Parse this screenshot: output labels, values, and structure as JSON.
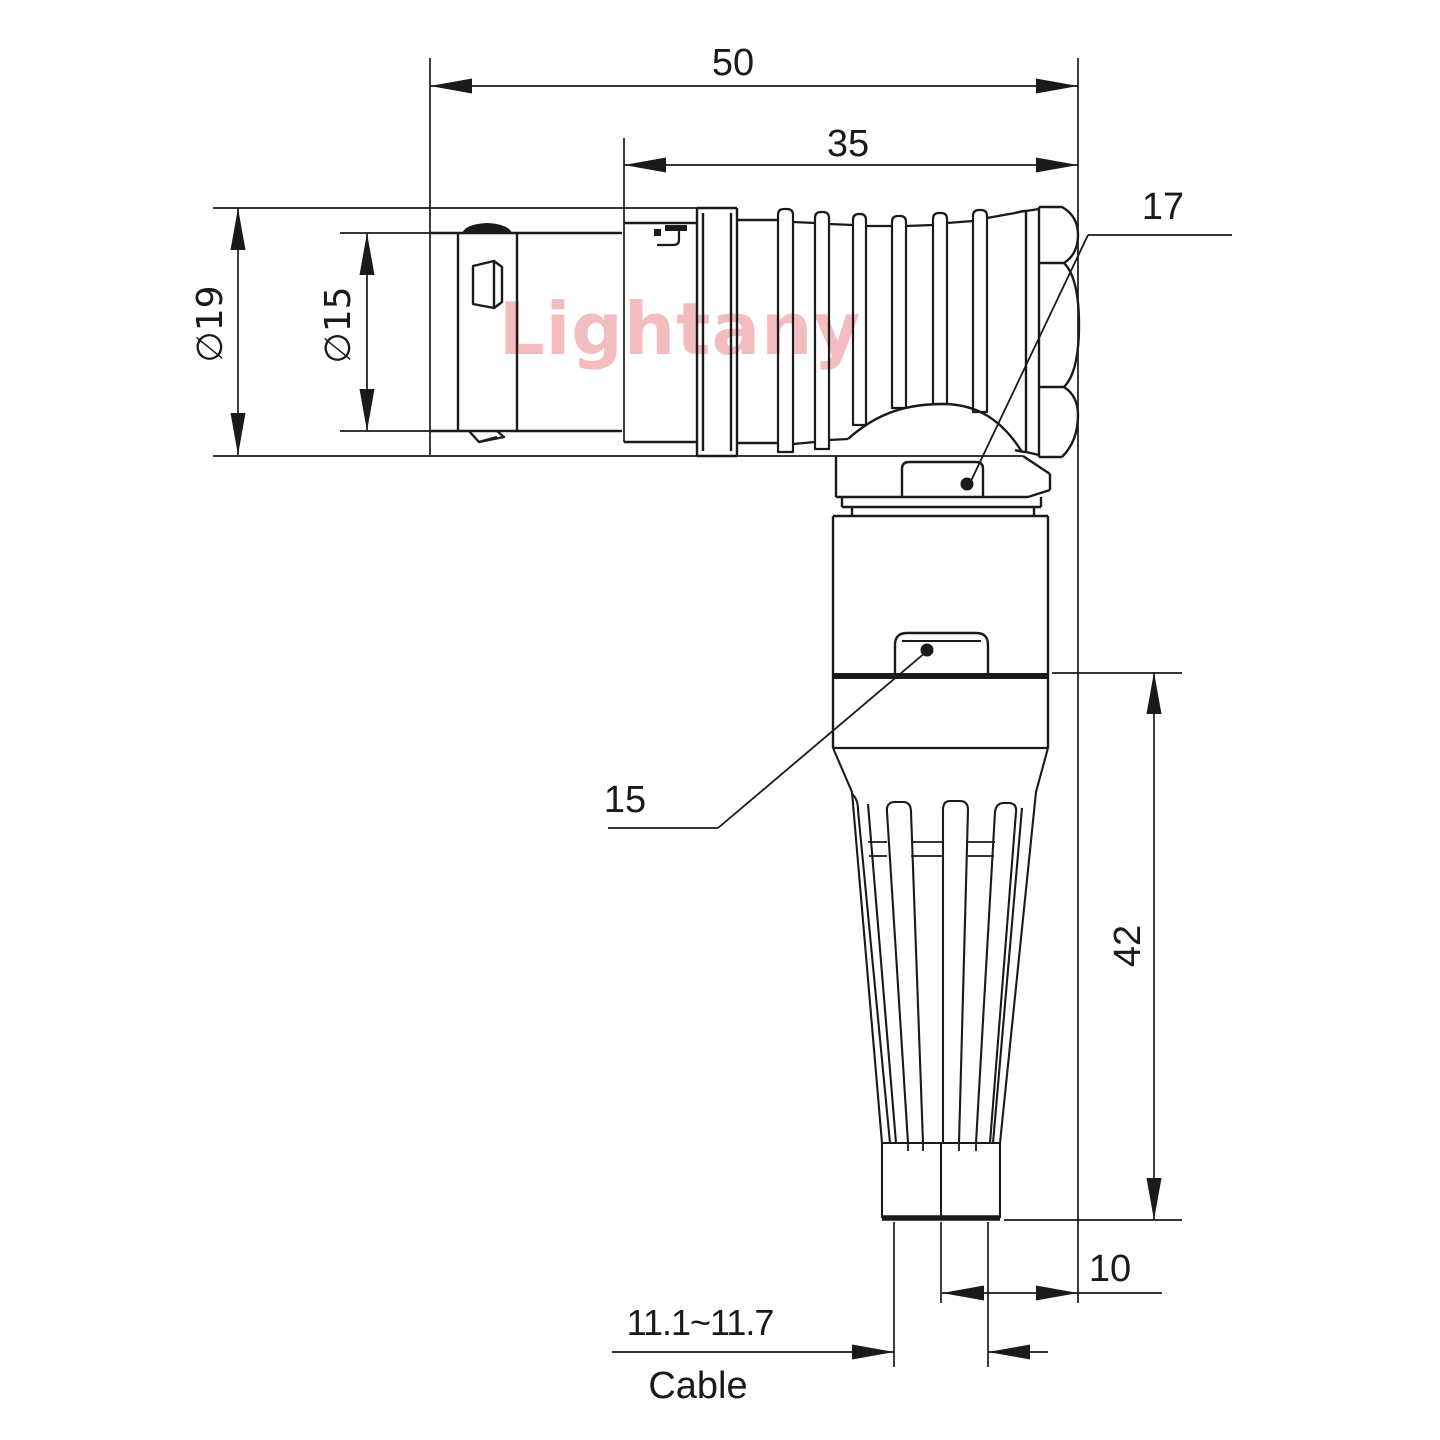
{
  "colors": {
    "line": "#1a1a1a",
    "watermark": "#f3bcbf"
  },
  "watermark_text": "Lightany",
  "dims": {
    "overall_length": "50",
    "rear_length": "35",
    "shell_diameter": "∅19",
    "front_diameter": "∅15",
    "nut_across_flats": "17",
    "body_across_flats": "15",
    "vertical_length": "42",
    "axis_to_rear_face": "10",
    "cable_diameter_range": "11.1~11.7",
    "cable_label": "Cable"
  }
}
